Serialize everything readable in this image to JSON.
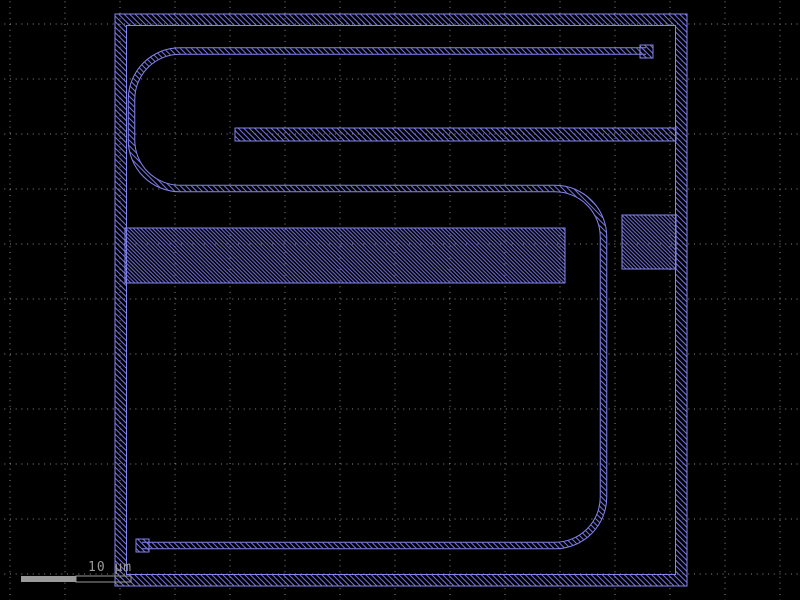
{
  "app": {
    "view": "ic-layout-canvas"
  },
  "canvas": {
    "width": 800,
    "height": 600,
    "background": "#000000"
  },
  "colors": {
    "shape_outline": "#8585f0",
    "shape_hatch": "#7272dd",
    "grid_dot": "#8a8a8a",
    "scalebar": "#9a9a9a",
    "scalebar_text": "#9a9a9a",
    "background": "#000000"
  },
  "grid": {
    "x_start": 10,
    "y_start": 24,
    "spacing": 55,
    "dot_dash": "1 4.7",
    "period": 5.7
  },
  "scale_bar": {
    "label": "10 µm",
    "x": 21,
    "y": 576,
    "segment_width": 55,
    "height": 6,
    "label_x": 88,
    "label_y": 571
  },
  "shapes": [
    {
      "name": "boundary-ring",
      "type": "ring",
      "hatch": "sparse",
      "outer": {
        "x": 115,
        "y": 14,
        "w": 572,
        "h": 572
      },
      "inner": {
        "x": 126.5,
        "y": 25.5,
        "w": 549,
        "h": 549
      }
    },
    {
      "name": "serpentine-trace",
      "type": "band-path",
      "hatch": "sparse",
      "d": "M646,51 H180 A48.5,48.5 0 0 0 131.5,99.5 V140 A48.5,48.5 0 0 0 180,188.5 H555 A48.5,48.5 0 0 1 603.5,237 V497 A48.5,48.5 0 0 1 555,545.5 H142",
      "outer_width": 7.5,
      "inner_width": 5.5
    },
    {
      "name": "trace-pad-top-right",
      "type": "rect",
      "hatch": "sparse",
      "x": 640,
      "y": 45,
      "w": 13,
      "h": 13
    },
    {
      "name": "trace-pad-bottom-left",
      "type": "rect",
      "hatch": "sparse",
      "x": 136,
      "y": 539,
      "w": 13,
      "h": 13
    },
    {
      "name": "stub-bar",
      "type": "rect",
      "hatch": "sparse",
      "x": 235,
      "y": 128,
      "w": 441,
      "h": 13
    },
    {
      "name": "wide-band",
      "type": "rect",
      "hatch": "dense",
      "x": 125,
      "y": 228,
      "w": 440,
      "h": 55
    },
    {
      "name": "right-pad",
      "type": "rect",
      "hatch": "dense",
      "x": 622,
      "y": 215,
      "w": 54,
      "h": 54
    }
  ]
}
